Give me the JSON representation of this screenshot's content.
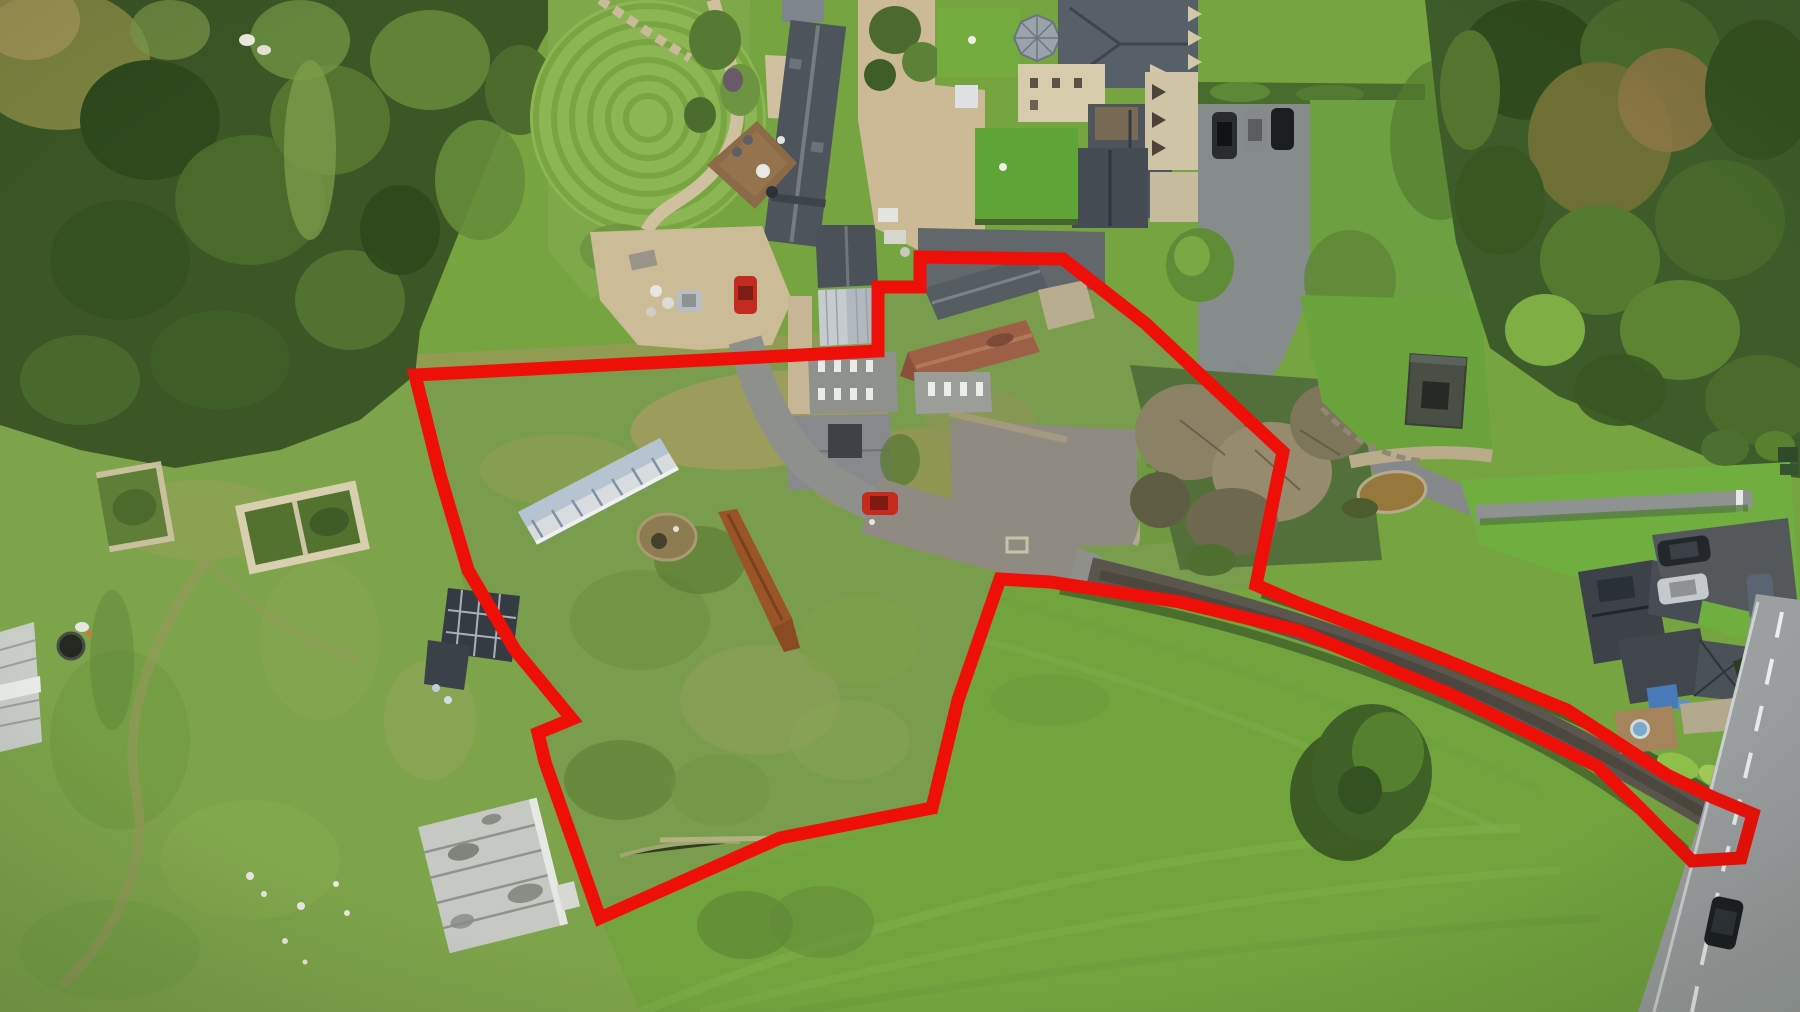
{
  "meta": {
    "kind": "aerial-drone-photograph",
    "description": "Overhead drone photo of a rural property complex with a thick red land-boundary line drawn over farm buildings, an overgrown walled garden, ruins, meadows and a narrow corridor strip running along a track to a public road",
    "canvas": {
      "width": 1800,
      "height": 1012
    },
    "visible_text": []
  },
  "palette": {
    "boundary_red": "#ee1008",
    "meadow_green": "#75a441",
    "rough_pasture": "#7ea44b",
    "garden_scrub": "#7a9c4d",
    "woodland_dark": "#3c5626",
    "lawn_bright": "#8cb554",
    "asphalt_light": "#8d9192",
    "asphalt_dark": "#62686b",
    "farm_track": "#6b655c",
    "gravel_tan": "#ccbb97",
    "slate_roof": "#4d545c",
    "red_tile_roof": "#9d6046",
    "white_structure": "#c9cdc9",
    "pond_brown": "#97783c",
    "red_car": "#c62a1f"
  },
  "boundary": {
    "name": "site-boundary-line",
    "color": "#ee1008",
    "stroke_width": 13,
    "closed": true,
    "points": [
      [
        415,
        375
      ],
      [
        878,
        351
      ],
      [
        878,
        287
      ],
      [
        920,
        287
      ],
      [
        920,
        257
      ],
      [
        1063,
        259
      ],
      [
        1145,
        323
      ],
      [
        1283,
        452
      ],
      [
        1256,
        585
      ],
      [
        1300,
        604
      ],
      [
        1433,
        655
      ],
      [
        1567,
        710
      ],
      [
        1667,
        775
      ],
      [
        1712,
        797
      ],
      [
        1753,
        814
      ],
      [
        1741,
        858
      ],
      [
        1692,
        861
      ],
      [
        1640,
        808
      ],
      [
        1597,
        766
      ],
      [
        1450,
        694
      ],
      [
        1300,
        631
      ],
      [
        1180,
        602
      ],
      [
        1050,
        582
      ],
      [
        1000,
        579
      ],
      [
        958,
        700
      ],
      [
        932,
        808
      ],
      [
        780,
        838
      ],
      [
        600,
        918
      ],
      [
        545,
        762
      ],
      [
        538,
        733
      ],
      [
        572,
        719
      ],
      [
        515,
        650
      ],
      [
        468,
        570
      ],
      [
        440,
        475
      ]
    ]
  },
  "landmarks": [
    {
      "name": "woodland",
      "note": "dense tree canopy filling the top-left corner"
    },
    {
      "name": "striped-lawn-garden",
      "note": "mowed lawn with concentric stripes and curving gravel paths"
    },
    {
      "name": "barn-conversion-house",
      "note": "long dark slate roof house top centre"
    },
    {
      "name": "timber-deck",
      "note": "deck with round table, chairs and hot tub beside the house"
    },
    {
      "name": "gravel-parking",
      "note": "tan parking area with a red hatchback and a silver car"
    },
    {
      "name": "country-mansion",
      "note": "large slate-roof mansion with octagonal glass lantern"
    },
    {
      "name": "mansion-car-park",
      "note": "grey tarmac with three dark parked cars and hedge"
    },
    {
      "name": "stone-barn-cluster",
      "note": "stone barn, red-tiled barn, skylight roofs, white lean-to"
    },
    {
      "name": "farmyard",
      "note": "tarmac yard with a red car parked by the barns"
    },
    {
      "name": "overgrown-walled-garden",
      "note": "scrubby enclosed plot inside the red boundary"
    },
    {
      "name": "ruined-stone-outbuildings",
      "note": "two roofless stone ruins in the left pasture"
    },
    {
      "name": "solar-panel-frames",
      "note": "dark panel frames inside the garden"
    },
    {
      "name": "striped-cold-frame",
      "note": "long blue-white gridded structure in the garden"
    },
    {
      "name": "rusty-roof-structure",
      "note": "narrow rusted corrugated roof strip"
    },
    {
      "name": "white-ruined-barn",
      "note": "large pale derelict barn lower left"
    },
    {
      "name": "trampoline",
      "note": "dark round trampoline in pasture"
    },
    {
      "name": "greenhouse",
      "note": "white glasshouse clipped by the left edge"
    },
    {
      "name": "hay-meadow",
      "note": "big smooth green field across the bottom"
    },
    {
      "name": "dead-trees",
      "note": "grey-brown leafless trees beside the corridor"
    },
    {
      "name": "garden-pond",
      "note": "small brown pond with stone edge"
    },
    {
      "name": "garden-shed",
      "note": "dark flat-roof structure with open centre"
    },
    {
      "name": "boundary-corridor-track",
      "note": "narrow red-lined strip along a dark track to the road"
    },
    {
      "name": "neighbour-house",
      "note": "dark-roof house right side with deck and hot tub"
    },
    {
      "name": "driveway-vehicles",
      "note": "dark SUV, white van and covered boat"
    },
    {
      "name": "public-road",
      "note": "grey road with dashed white centreline and one dark car"
    }
  ]
}
